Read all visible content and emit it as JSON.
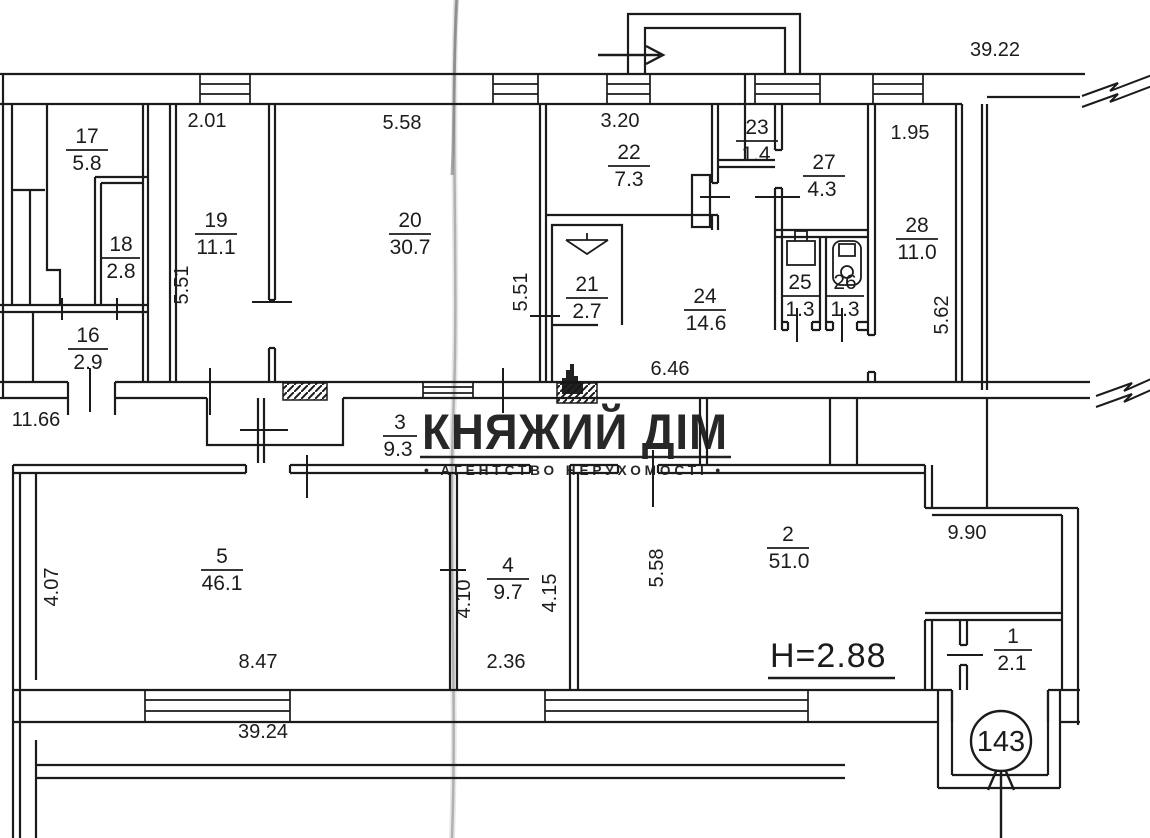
{
  "watermark": {
    "title": "КНЯЖИЙ ДІМ",
    "subtitle": "• АГЕНТСТВО НЕРУХОМОСТІ •"
  },
  "notes": {
    "ceiling_height": "Н=2.88",
    "entrance_number": "143"
  },
  "rooms": {
    "r1": {
      "number": "1",
      "area": "2.1"
    },
    "r2": {
      "number": "2",
      "area": "51.0"
    },
    "r3": {
      "number": "3",
      "area": "9.3"
    },
    "r4": {
      "number": "4",
      "area": "9.7"
    },
    "r5": {
      "number": "5",
      "area": "46.1"
    },
    "r16": {
      "number": "16",
      "area": "2.9"
    },
    "r17": {
      "number": "17",
      "area": "5.8"
    },
    "r18": {
      "number": "18",
      "area": "2.8"
    },
    "r19": {
      "number": "19",
      "area": "11.1"
    },
    "r20": {
      "number": "20",
      "area": "30.7"
    },
    "r21": {
      "number": "21",
      "area": "2.7"
    },
    "r22": {
      "number": "22",
      "area": "7.3"
    },
    "r23": {
      "number": "23",
      "area": "1.4"
    },
    "r24": {
      "number": "24",
      "area": "14.6"
    },
    "r25": {
      "number": "25",
      "area": "1.3"
    },
    "r26": {
      "number": "26",
      "area": "1.3"
    },
    "r27": {
      "number": "27",
      "area": "4.3"
    },
    "r28": {
      "number": "28",
      "area": "11.0"
    }
  },
  "dimensions": {
    "top_overall": "39.22",
    "bottom_overall": "39.24",
    "top_19": "2.01",
    "top_20": "5.58",
    "top_22": "3.20",
    "top_28": "1.95",
    "left_19": "5.51",
    "left_21": "5.51",
    "right_28": "5.62",
    "corridor_24": "6.46",
    "corridor_left": "11.66",
    "left_5": "4.07",
    "bottom_5": "8.47",
    "bottom_4": "2.36",
    "left_4": "4.10",
    "right_4": "4.15",
    "left_2": "5.58",
    "right_2": "9.90"
  }
}
